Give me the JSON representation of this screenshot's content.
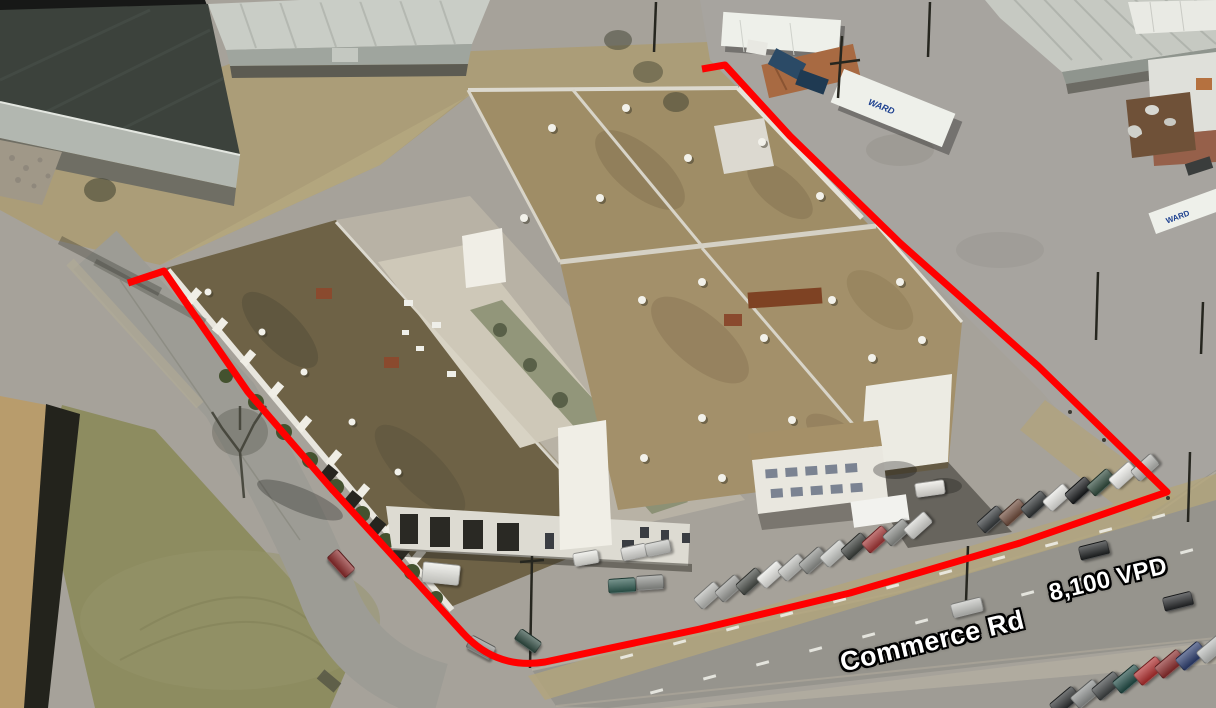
{
  "scene": {
    "annotations": {
      "road_label": "Commerce Rd",
      "traffic_label": "8,100 VPD"
    },
    "trailer_label": "WARD",
    "colors": {
      "boundary": "#ff0000",
      "label_text": "#ffffff",
      "label_outline": "#000000",
      "roof_tan": "#a3906a",
      "roof_dark_wing": "#6e6246",
      "warehouse_dark_roof": "#3c423c",
      "grass_field": "#8d8c60",
      "pavement": "#9d9c95",
      "building_white": "#e9e7df"
    },
    "vehicles": [
      {
        "x": 707,
        "y": 594,
        "a": -42,
        "c": "#b8b9b5"
      },
      {
        "x": 728,
        "y": 587,
        "a": -42,
        "c": "#9b9c98"
      },
      {
        "x": 749,
        "y": 580,
        "a": -42,
        "c": "#454944"
      },
      {
        "x": 770,
        "y": 573,
        "a": -42,
        "c": "#e8e8e4"
      },
      {
        "x": 791,
        "y": 566,
        "a": -42,
        "c": "#c1c2be"
      },
      {
        "x": 812,
        "y": 559,
        "a": -42,
        "c": "#8d8f8b"
      },
      {
        "x": 833,
        "y": 552,
        "a": -42,
        "c": "#c9cbc7"
      },
      {
        "x": 854,
        "y": 545,
        "a": -42,
        "c": "#383c38"
      },
      {
        "x": 875,
        "y": 538,
        "a": -42,
        "c": "#a23333"
      },
      {
        "x": 896,
        "y": 531,
        "a": -42,
        "c": "#898b87"
      },
      {
        "x": 917,
        "y": 524,
        "a": -42,
        "c": "#d7d7d3"
      },
      {
        "x": 990,
        "y": 518,
        "a": -42,
        "c": "#34383a"
      },
      {
        "x": 1012,
        "y": 511,
        "a": -42,
        "c": "#6d4939"
      },
      {
        "x": 1034,
        "y": 503,
        "a": -42,
        "c": "#2d3132"
      },
      {
        "x": 1056,
        "y": 496,
        "a": -42,
        "c": "#e7e7e3"
      },
      {
        "x": 1078,
        "y": 489,
        "a": -42,
        "c": "#16181a"
      },
      {
        "x": 1100,
        "y": 481,
        "a": -42,
        "c": "#2e493b"
      },
      {
        "x": 1122,
        "y": 474,
        "a": -42,
        "c": "#efefeb"
      },
      {
        "x": 1144,
        "y": 466,
        "a": -42,
        "c": "#b8b9b5"
      },
      {
        "x": 1064,
        "y": 700,
        "a": -40,
        "c": "#2a2d2e",
        "w": 28,
        "h": 14
      },
      {
        "x": 1085,
        "y": 693,
        "a": -40,
        "c": "#8d908f",
        "w": 28,
        "h": 14
      },
      {
        "x": 1106,
        "y": 685,
        "a": -40,
        "c": "#3b3f40",
        "w": 28,
        "h": 14
      },
      {
        "x": 1127,
        "y": 678,
        "a": -40,
        "c": "#1f4a44",
        "w": 28,
        "h": 14
      },
      {
        "x": 1148,
        "y": 670,
        "a": -40,
        "c": "#b02c2c",
        "w": 28,
        "h": 14
      },
      {
        "x": 1169,
        "y": 663,
        "a": -40,
        "c": "#8b2a2a",
        "w": 28,
        "h": 14
      },
      {
        "x": 1190,
        "y": 655,
        "a": -40,
        "c": "#2b3c6e",
        "w": 28,
        "h": 14
      },
      {
        "x": 1211,
        "y": 648,
        "a": -40,
        "c": "#bfc1bf",
        "w": 28,
        "h": 14
      },
      {
        "x": 966,
        "y": 606,
        "a": -14,
        "c": "#c4c5c1",
        "w": 30,
        "h": 13
      },
      {
        "x": 1093,
        "y": 549,
        "a": -14,
        "c": "#1e2122",
        "w": 28,
        "h": 13
      },
      {
        "x": 1177,
        "y": 600,
        "a": -14,
        "c": "#232527",
        "w": 28,
        "h": 13
      },
      {
        "x": 340,
        "y": 562,
        "a": 48,
        "c": "#8b2929"
      },
      {
        "x": 585,
        "y": 557,
        "a": -10,
        "c": "#e9e9e3",
        "w": 24,
        "h": 12
      },
      {
        "x": 633,
        "y": 551,
        "a": -12,
        "c": "#dcdcd8",
        "w": 24,
        "h": 12
      },
      {
        "x": 657,
        "y": 547,
        "a": -12,
        "c": "#c7c8c4",
        "w": 24,
        "h": 12
      },
      {
        "x": 621,
        "y": 584,
        "a": -4,
        "c": "#2e5a50"
      },
      {
        "x": 649,
        "y": 581,
        "a": -4,
        "c": "#90928e"
      },
      {
        "x": 440,
        "y": 572,
        "a": 6,
        "c": "#e9e9e3",
        "w": 36,
        "h": 19
      },
      {
        "x": 480,
        "y": 646,
        "a": 28,
        "c": "#8f918d"
      },
      {
        "x": 527,
        "y": 640,
        "a": 35,
        "c": "#2e4a40",
        "w": 24,
        "h": 12
      },
      {
        "x": 929,
        "y": 487,
        "a": -8,
        "c": "#ebe9e3",
        "w": 28,
        "h": 13
      }
    ]
  }
}
